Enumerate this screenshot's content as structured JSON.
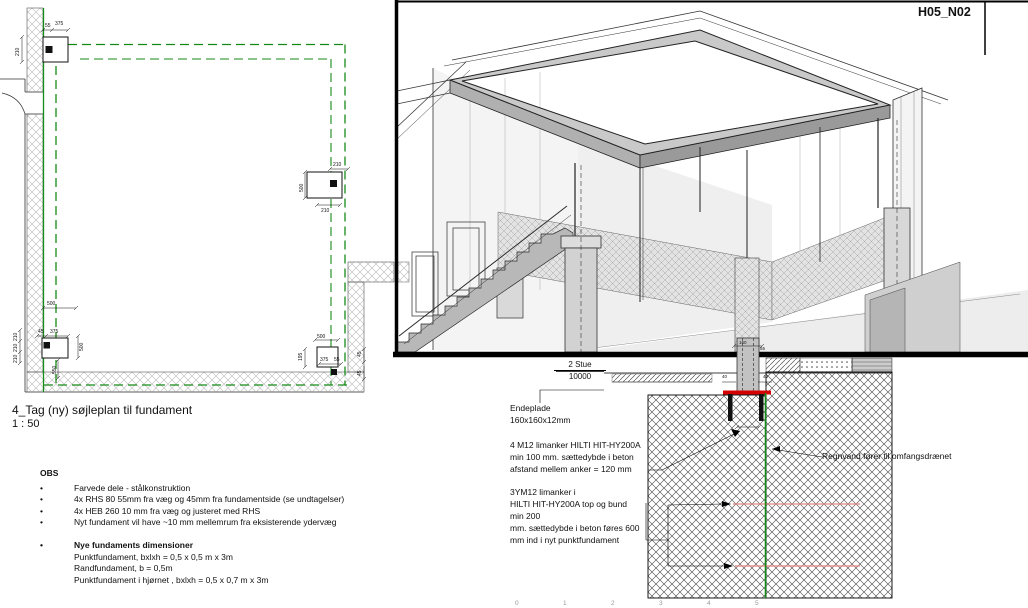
{
  "plan": {
    "title": "4_Tag (ny) søjleplan til fundament",
    "scale": "1 : 50",
    "dim_labels": [
      {
        "t": "55",
        "x": 45,
        "y": 27
      },
      {
        "t": "375",
        "x": 55,
        "y": 25
      },
      {
        "t": "210",
        "x": 19,
        "y": 56,
        "r": -90
      },
      {
        "t": "210",
        "x": 333,
        "y": 166
      },
      {
        "t": "500",
        "x": 303,
        "y": 192,
        "r": -90
      },
      {
        "t": "210",
        "x": 321,
        "y": 212
      },
      {
        "t": "500",
        "x": 47,
        "y": 305
      },
      {
        "t": "210",
        "x": 17,
        "y": 341,
        "r": -90
      },
      {
        "t": "210",
        "x": 17,
        "y": 352,
        "r": -90
      },
      {
        "t": "210",
        "x": 17,
        "y": 363,
        "r": -90
      },
      {
        "t": "45",
        "x": 38,
        "y": 333
      },
      {
        "t": "375",
        "x": 50,
        "y": 333
      },
      {
        "t": "500",
        "x": 83,
        "y": 351,
        "r": -90
      },
      {
        "t": "550",
        "x": 56,
        "y": 374,
        "r": -90
      },
      {
        "t": "500",
        "x": 317,
        "y": 338
      },
      {
        "t": "195",
        "x": 302,
        "y": 361,
        "r": -90
      },
      {
        "t": "375",
        "x": 320,
        "y": 361
      },
      {
        "t": "55",
        "x": 334,
        "y": 361
      },
      {
        "t": "45",
        "x": 361,
        "y": 357,
        "r": -90
      },
      {
        "t": "45",
        "x": 361,
        "y": 376,
        "r": -90
      }
    ]
  },
  "notes": {
    "heading": "OBS",
    "bullet_char": "•",
    "bullets": [
      "Farvede dele - stålkonstruktion",
      "4x RHS 80 55mm fra væg og 45mm fra fundamentside (se undtagelser)",
      "4x HEB 260 10 mm fra væg og justeret med RHS",
      "Nyt fundament vil have ~10 mm mellemrum fra eksisterende ydervæg"
    ],
    "dim_heading": "Nye fundaments dimensioner",
    "dim_lines": [
      "Punktfundament, bxlxh = 0,5 x 0,5 m x 3m",
      "Randfundament, b = 0,5m",
      "Punktfundament i hjørnet , bxlxh = 0,5 x 0,7 m x 3m"
    ]
  },
  "view3d": {
    "label": "H05_N02"
  },
  "section": {
    "level": {
      "name": "2 Stue",
      "elevation": "10000"
    },
    "annotations": {
      "endeplade": [
        "Endeplade",
        "160x160x12mm"
      ],
      "anchors_top": [
        "4 M12 limanker HILTI HIT-HY200A",
        "min 100 mm. sættedybde i beton",
        "afstand mellem anker = 120 mm"
      ],
      "anchors_side": [
        "3YM12 limanker i",
        "HILTI HIT-HY200A top og bund",
        "min 200",
        "mm. sættedybde i beton føres 600",
        "mm ind i nyt punktfundament"
      ],
      "rain": "Regnvand fører til omfangsdrænet"
    },
    "col_dim_labels": [
      {
        "t": "160",
        "x": 739,
        "y": 344
      },
      {
        "t": "55",
        "x": 760,
        "y": 350
      },
      {
        "t": "40",
        "x": 722,
        "y": 378
      },
      {
        "t": "40",
        "x": 763,
        "y": 378
      }
    ],
    "ruler_labels": [
      "0",
      "1",
      "2",
      "3",
      "4",
      "5"
    ]
  },
  "colors": {
    "accent_green": "#168a16",
    "steel_red": "#d40000",
    "rebar_red": "#e8837f"
  }
}
